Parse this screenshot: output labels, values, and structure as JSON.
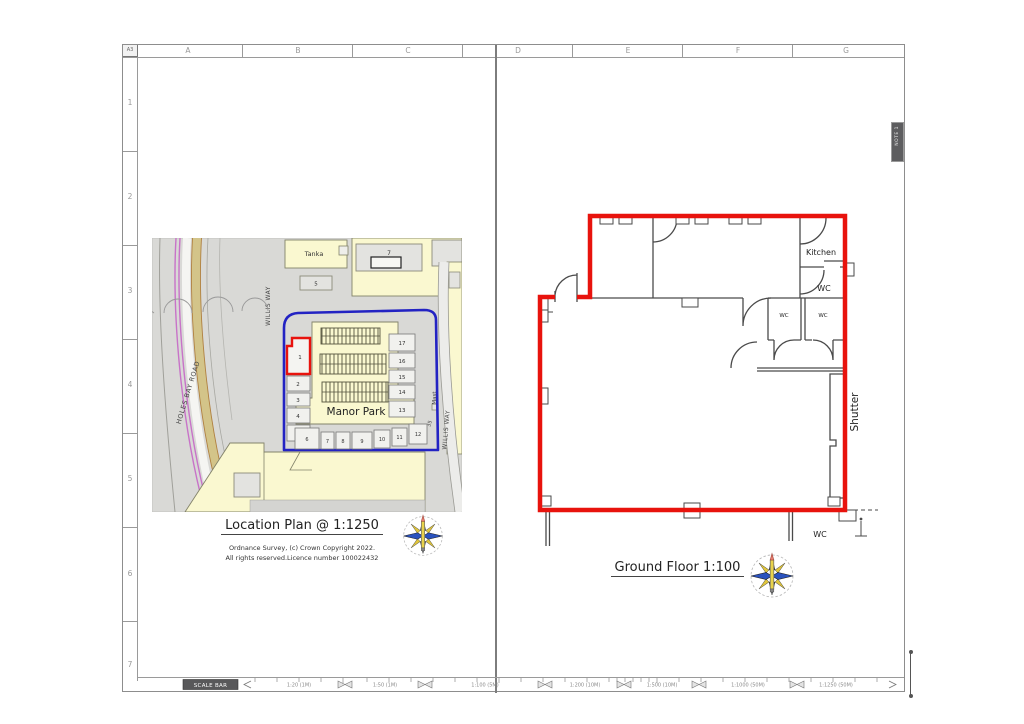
{
  "sheet": {
    "size_label": "A3",
    "note_tag": "NOTE 1"
  },
  "grid": {
    "cols": [
      "A",
      "B",
      "C",
      "D",
      "E",
      "F",
      "G"
    ],
    "rows": [
      "1",
      "2",
      "3",
      "4",
      "5",
      "6",
      "7"
    ]
  },
  "location_plan": {
    "title": "Location Plan  @  1:1250",
    "copyright_line1": "Ordnance Survey, (c) Crown Copyright 2022.",
    "copyright_line2": "All rights reserved.Licence number 100022432",
    "map": {
      "site_name": "Manor Park",
      "street_left": "WILLIS WAY",
      "street_right": "WILLIS WAY",
      "road": "HOLES BAY ROAD",
      "labels": {
        "tanks": "Tanka",
        "bldg7": "7",
        "bldg5": "5",
        "mast": "Mast",
        "n35": "35"
      },
      "units_left": [
        "1",
        "2",
        "3",
        "4",
        "5"
      ],
      "units_right": [
        "17",
        "16",
        "15",
        "14",
        "13"
      ],
      "units_bottom": [
        "6",
        "7",
        "8",
        "9",
        "10",
        "11",
        "12"
      ],
      "colors": {
        "site_boundary": "#2323c3",
        "unit_highlight": "#e8130d",
        "building_fill": "#faf8d0",
        "map_bg": "#d9d9d6"
      }
    }
  },
  "floor_plan": {
    "title": "Ground Floor 1:100",
    "rooms": {
      "kitchen": "Kitchen",
      "wc_main": "WC",
      "wc_small_left": "WC",
      "wc_small_right": "WC",
      "wc_outside": "WC",
      "shutter": "Shutter"
    },
    "colors": {
      "demise": "#e8130d",
      "walls": "#4a4a4a"
    }
  },
  "scale_bar": {
    "label": "SCALE BAR",
    "segments": [
      "1:20 (1M)",
      "1:50 (1M)",
      "1:100 (5M)",
      "1:200 (10M)",
      "1:500 (10M)",
      "1:1000 (50M)",
      "1:1250 (50M)"
    ]
  }
}
